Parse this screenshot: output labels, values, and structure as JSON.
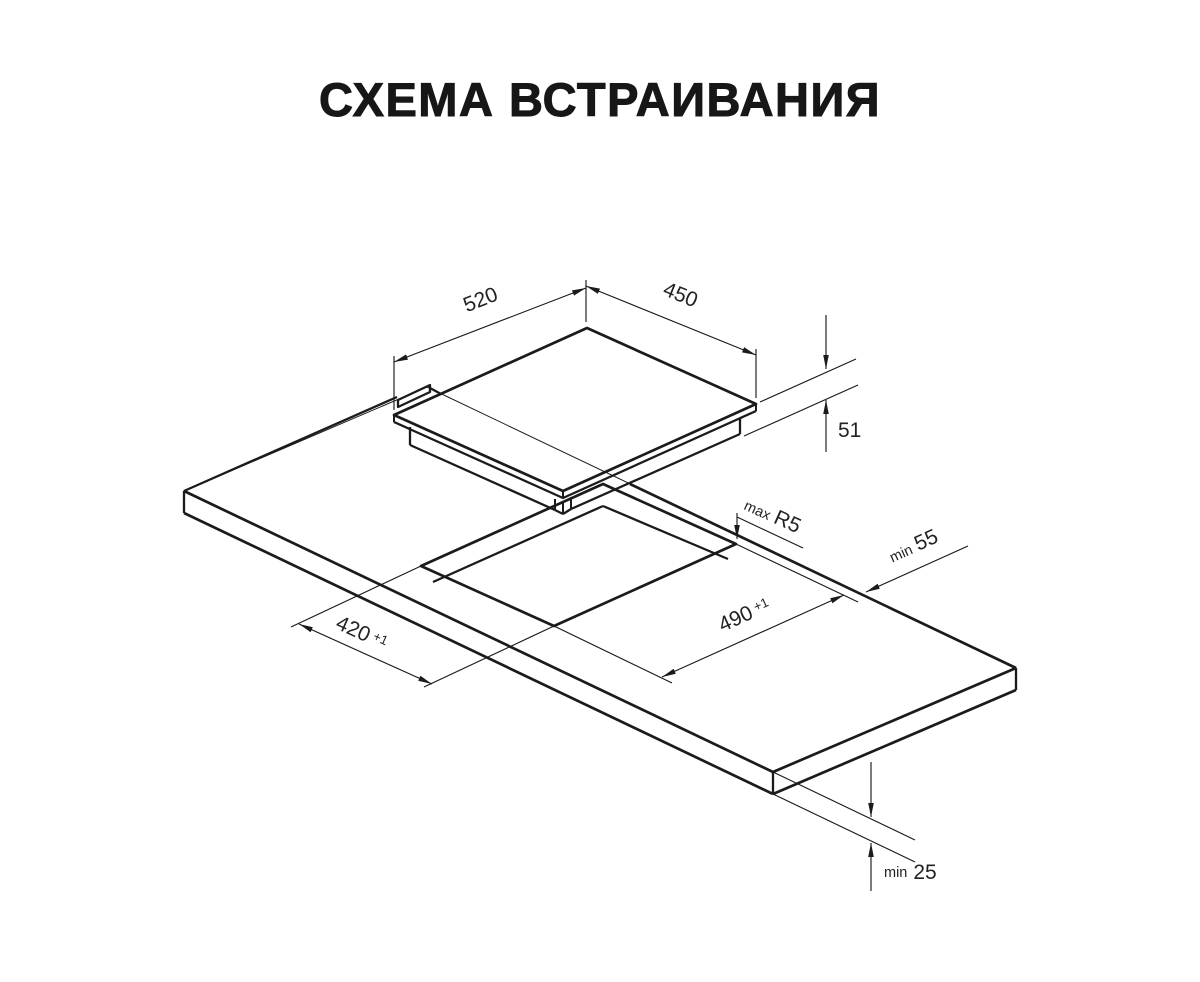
{
  "title": "СХЕМА ВСТРАИВАНИЯ",
  "hob": {
    "width": "520",
    "depth": "450",
    "height": "51"
  },
  "cutout": {
    "width": "420",
    "width_tolerance": "+1",
    "depth": "490",
    "depth_tolerance": "+1",
    "corner_radius_prefix": "max",
    "corner_radius": "R5",
    "edge_clearance_prefix": "min",
    "edge_clearance": "55"
  },
  "countertop": {
    "thickness_prefix": "min",
    "thickness": "25"
  },
  "colors": {
    "line": "#1b1b1b",
    "background": "#ffffff"
  }
}
